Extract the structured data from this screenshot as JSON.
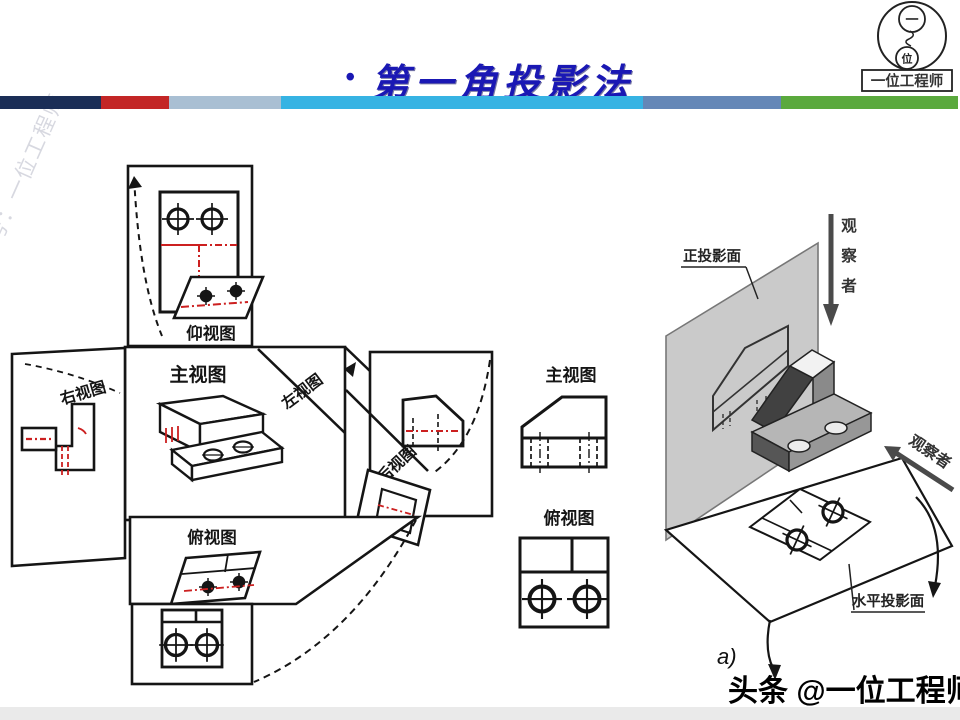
{
  "header": {
    "bullet": "•",
    "title": "第一角投影法",
    "title_color": "#1a18b4",
    "bar_segments": [
      {
        "color": "#1b2e57",
        "width": 101
      },
      {
        "color": "#c32626",
        "width": 68
      },
      {
        "color": "#a9bfd3",
        "width": 112
      },
      {
        "color": "#36b3e3",
        "width": 362
      },
      {
        "color": "#6487b7",
        "width": 138
      },
      {
        "color": "#5aa93d",
        "width": 177
      }
    ]
  },
  "logo": {
    "inner_top": "一",
    "inner_bottom": "位",
    "caption": "一位工程师"
  },
  "watermark": {
    "text": "头条号：一位工程师"
  },
  "unfold_diagram": {
    "line_color": "#151515",
    "hidden_color": "#cc2020",
    "labels": {
      "bottom_view": "仰视图",
      "front_view": "主视图",
      "right_view": "右视图",
      "left_view": "左视图",
      "rear_view": "后视图",
      "top_view": "俯视图"
    }
  },
  "flat_views": {
    "front_label": "主视图",
    "top_label": "俯视图"
  },
  "scene": {
    "frontal_plane": "正投影面",
    "horizontal_plane": "水平投影面",
    "observer_vertical": [
      "观",
      "察",
      "者"
    ],
    "observer_side": "观察者",
    "sub_label": "a)",
    "plane_color": "#cacaca"
  },
  "footer": {
    "credit": "头条 @一位工程师"
  }
}
